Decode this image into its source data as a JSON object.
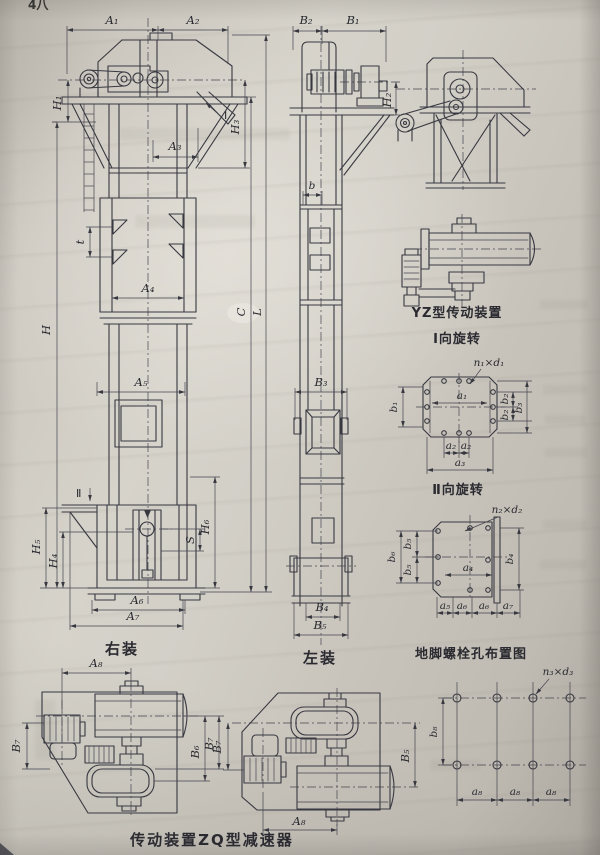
{
  "page": {
    "corner_note": "4八"
  },
  "front_view": {
    "caption": "右装",
    "labels": {
      "A1": "A₁",
      "A2": "A₂",
      "H1": "H₁",
      "H3": "H₃",
      "A3": "A₃",
      "I": "Ⅰ",
      "t": "t",
      "A4": "A₄",
      "H": "H",
      "C": "C",
      "L": "L",
      "A5": "A₅",
      "II": "Ⅱ",
      "H5": "H₅",
      "H4": "H₄",
      "S": "S",
      "H6": "H₆",
      "A6": "A₆",
      "A7": "A₇"
    }
  },
  "side_view": {
    "caption": "左装",
    "labels": {
      "B2": "B₂",
      "B1": "B₁",
      "H2": "H₂",
      "b": "b",
      "B3": "B₃",
      "B4": "B₄",
      "B5": "B₅"
    }
  },
  "yz_drive": {
    "caption": "YZ型传动装置"
  },
  "rotation_I": {
    "caption": "Ⅰ向旋转",
    "labels": {
      "nd": "n₁×d₁",
      "b1": "b₁",
      "a1": "a₁",
      "b2a": "b₂",
      "b2b": "b₂",
      "b3": "b₃",
      "a2a": "a₂",
      "a2b": "a₂",
      "a3": "a₃"
    }
  },
  "rotation_II": {
    "caption": "Ⅱ向旋转",
    "labels": {
      "nd": "n₂×d₂",
      "b6": "b₆",
      "b5a": "b₅",
      "b5b": "b₅",
      "b4": "b₄",
      "a4": "a₄",
      "a5": "a₅",
      "a6a": "a₆",
      "a6b": "a₆",
      "a7": "a₇"
    }
  },
  "anchor_plan": {
    "caption": "地脚螺栓孔布置图",
    "labels": {
      "nd": "n₃×d₃",
      "b8": "b₈",
      "a8a": "a₈",
      "a8b": "a₈",
      "a8c": "a₈"
    }
  },
  "zq_drive": {
    "caption": "传动装置ZQ型减速器",
    "left": {
      "A8": "A₈",
      "B7_left": "B₇",
      "B6": "B₆",
      "B7_right": "B₇"
    },
    "right": {
      "B7": "B₇",
      "B5": "B₅",
      "A8": "A₈"
    }
  }
}
